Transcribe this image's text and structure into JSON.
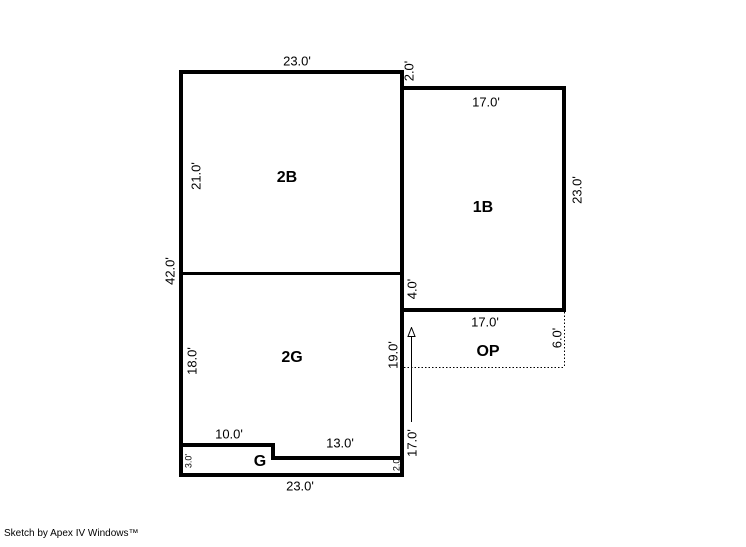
{
  "canvas": {
    "width": 746,
    "height": 547,
    "background": "#ffffff",
    "line_color": "#000000"
  },
  "credit": "Sketch by Apex IV Windows™",
  "rooms": {
    "b2": {
      "label": "2B"
    },
    "b1": {
      "label": "1B"
    },
    "g2": {
      "label": "2G"
    },
    "g": {
      "label": "G"
    },
    "op": {
      "label": "OP"
    }
  },
  "dimensions": {
    "b2_top": "23.0'",
    "b2_left": "21.0'",
    "left_total": "42.0'",
    "b1_top_offset": "2.0'",
    "b1_top": "17.0'",
    "b1_right": "23.0'",
    "b1_left_lower": "4.0'",
    "op_top": "17.0'",
    "op_right": "6.0'",
    "g2_left": "18.0'",
    "g2_right": "19.0'",
    "g_upper": "10.0'",
    "g_lower": "13.0'",
    "g_left_height": "3.0'",
    "g_right_height": "2.0'",
    "bottom": "23.0'",
    "right_side_arrow": "17.0'"
  },
  "icons": {
    "arrowhead_up": "hollow triangle pointing up"
  }
}
